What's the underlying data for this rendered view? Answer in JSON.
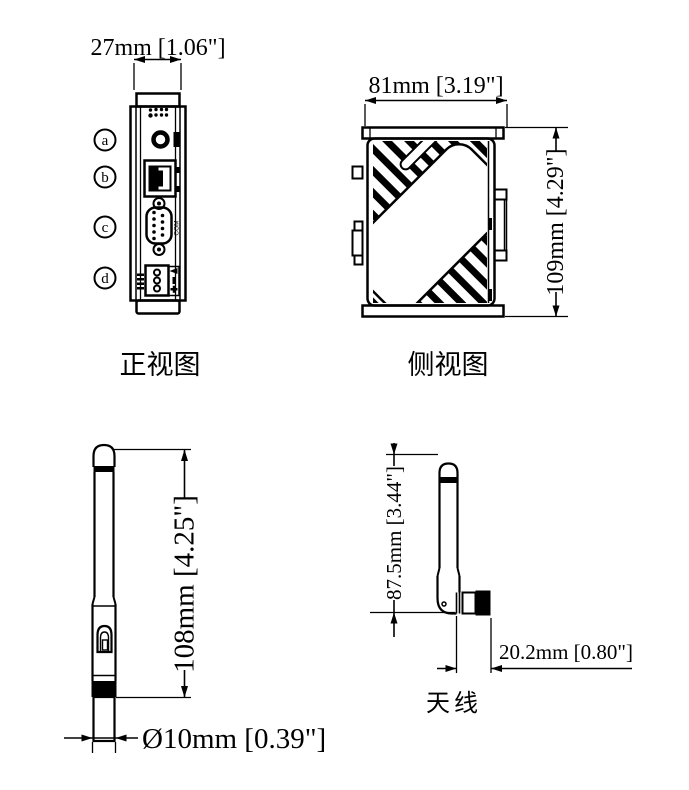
{
  "front_view": {
    "label": "正视图",
    "width_dim": "27mm [1.06\"]",
    "callouts": [
      "a",
      "b",
      "c",
      "d"
    ],
    "com_label": "COM"
  },
  "side_view": {
    "label": "侧视图",
    "width_dim": "81mm [3.19\"]",
    "height_dim": "109mm [4.29\"]"
  },
  "antenna_front_view": {
    "length_dim": "108mm [4.25\"]",
    "diameter_dim": "Ø10mm [0.39\"]"
  },
  "antenna_side_view": {
    "label": "天线",
    "height_dim": "87.5mm [3.44\"]",
    "connector_dim": "20.2mm [0.80\"]"
  },
  "colors": {
    "line": "#000000",
    "background": "#ffffff"
  }
}
